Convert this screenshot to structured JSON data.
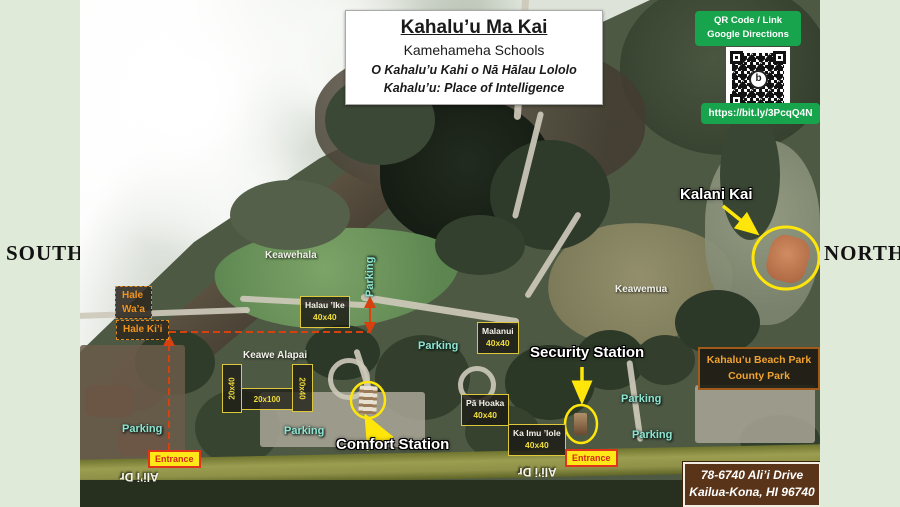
{
  "compass": {
    "south": "SOUTH",
    "north": "NORTH"
  },
  "title_card": {
    "title": "Kahalu’u Ma Kai",
    "subtitle": "Kamehameha Schools",
    "motto1": "O Kahalu’u Kahi o Nā Hālau Lololo",
    "motto2": "Kahalu’u: Place of Intelligence"
  },
  "qr_panel": {
    "label1": "QR Code / Link",
    "label2": "Google Directions",
    "url": "https://bit.ly/3PcqQ4N",
    "logo_letter": "b"
  },
  "map": {
    "site_label": "Kalani Kai",
    "areas": {
      "keawehala": "Keawehala",
      "keawemua": "Keawemua",
      "keawe_alapai": "Keawe Alapai"
    },
    "halls": {
      "hale_waa_1": "Hale",
      "hale_waa_2": "Wa’a",
      "hale_kii": "Hale Ki’i"
    },
    "buildings": [
      {
        "name": "Halau ’Ike",
        "size": "40x40"
      },
      {
        "name": "Malanui",
        "size": "40x40"
      },
      {
        "name": "Pā Hoaka",
        "size": "40x40"
      },
      {
        "name": "Ka Imu ’Iole",
        "size": "40x40"
      }
    ],
    "lots": [
      {
        "size": "20x40"
      },
      {
        "size": "20x100"
      },
      {
        "size": "20x40"
      }
    ],
    "stations": {
      "security": "Security Station",
      "comfort": "Comfort Station"
    },
    "parking": "Parking",
    "entrance": "Entrance",
    "road": "Ali’i Dr",
    "beach_park": {
      "line1": "Kahalu’u Beach Park",
      "line2": "County Park"
    },
    "address": {
      "line1": "78-6740 Ali’i Drive",
      "line2": "Kailua-Kona, HI 96740"
    }
  },
  "colors": {
    "link_green": "#18a44c",
    "annotation_yellow": "#ffe60a",
    "boundary_red": "#d8400e"
  }
}
